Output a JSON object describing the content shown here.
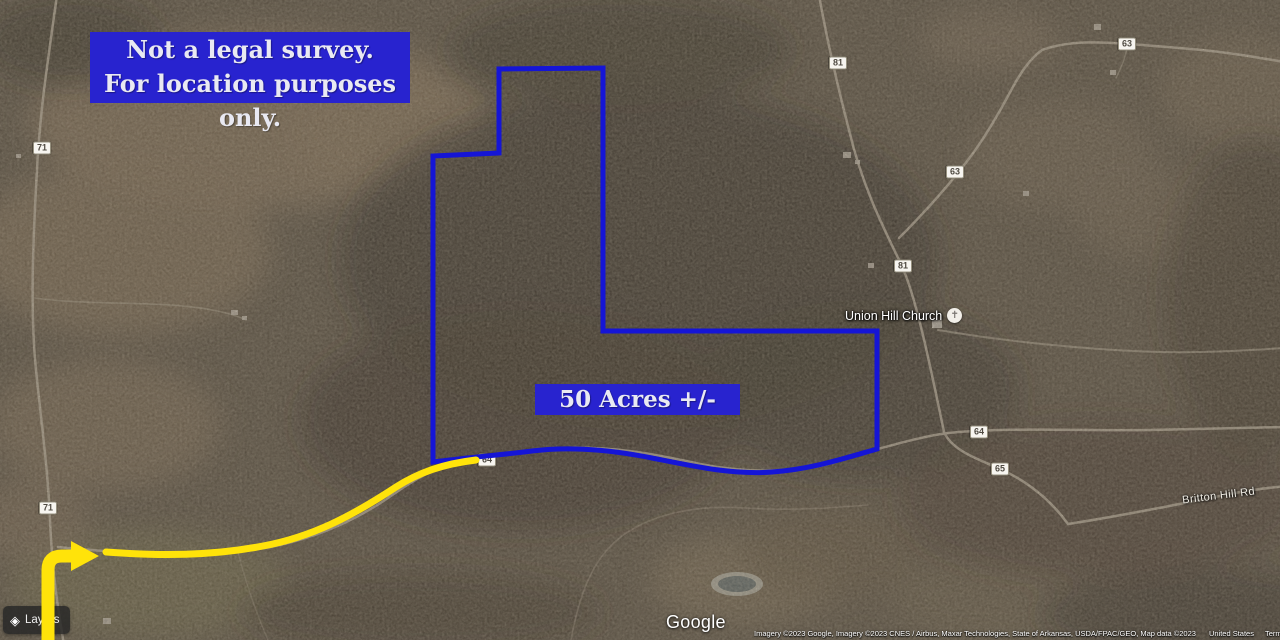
{
  "disclaimer": {
    "line1": "Not a legal survey.",
    "line2": "For location purposes only."
  },
  "acreage_label": "50 Acres +/-",
  "map_labels": {
    "church": "Union Hill Church",
    "road_name": "Britton Hill Rd",
    "shields": [
      {
        "label": "71",
        "x": 42,
        "y": 148
      },
      {
        "label": "71",
        "x": 48,
        "y": 508
      },
      {
        "label": "81",
        "x": 838,
        "y": 63
      },
      {
        "label": "81",
        "x": 903,
        "y": 266
      },
      {
        "label": "63",
        "x": 955,
        "y": 172
      },
      {
        "label": "63",
        "x": 1127,
        "y": 44
      },
      {
        "label": "64",
        "x": 487,
        "y": 460
      },
      {
        "label": "64",
        "x": 979,
        "y": 432
      },
      {
        "label": "65",
        "x": 1000,
        "y": 469
      }
    ]
  },
  "icons": {
    "church": "✝",
    "layers": "◈"
  },
  "colors": {
    "annotation_blue": "#2823cf",
    "boundary_blue": "#1515d6",
    "route_yellow": "#ffe30a"
  },
  "google_logo": "Google",
  "attribution": {
    "imagery": "Imagery ©2023 Google, Imagery ©2023 CNES / Airbus, Maxar Technologies, State of Arkansas, USDA/FPAC/GEO, Map data ©2023",
    "links": [
      "United States",
      "Terms",
      "Privacy",
      "Send feedback"
    ]
  },
  "controls": {
    "layers_label": "Layers"
  }
}
